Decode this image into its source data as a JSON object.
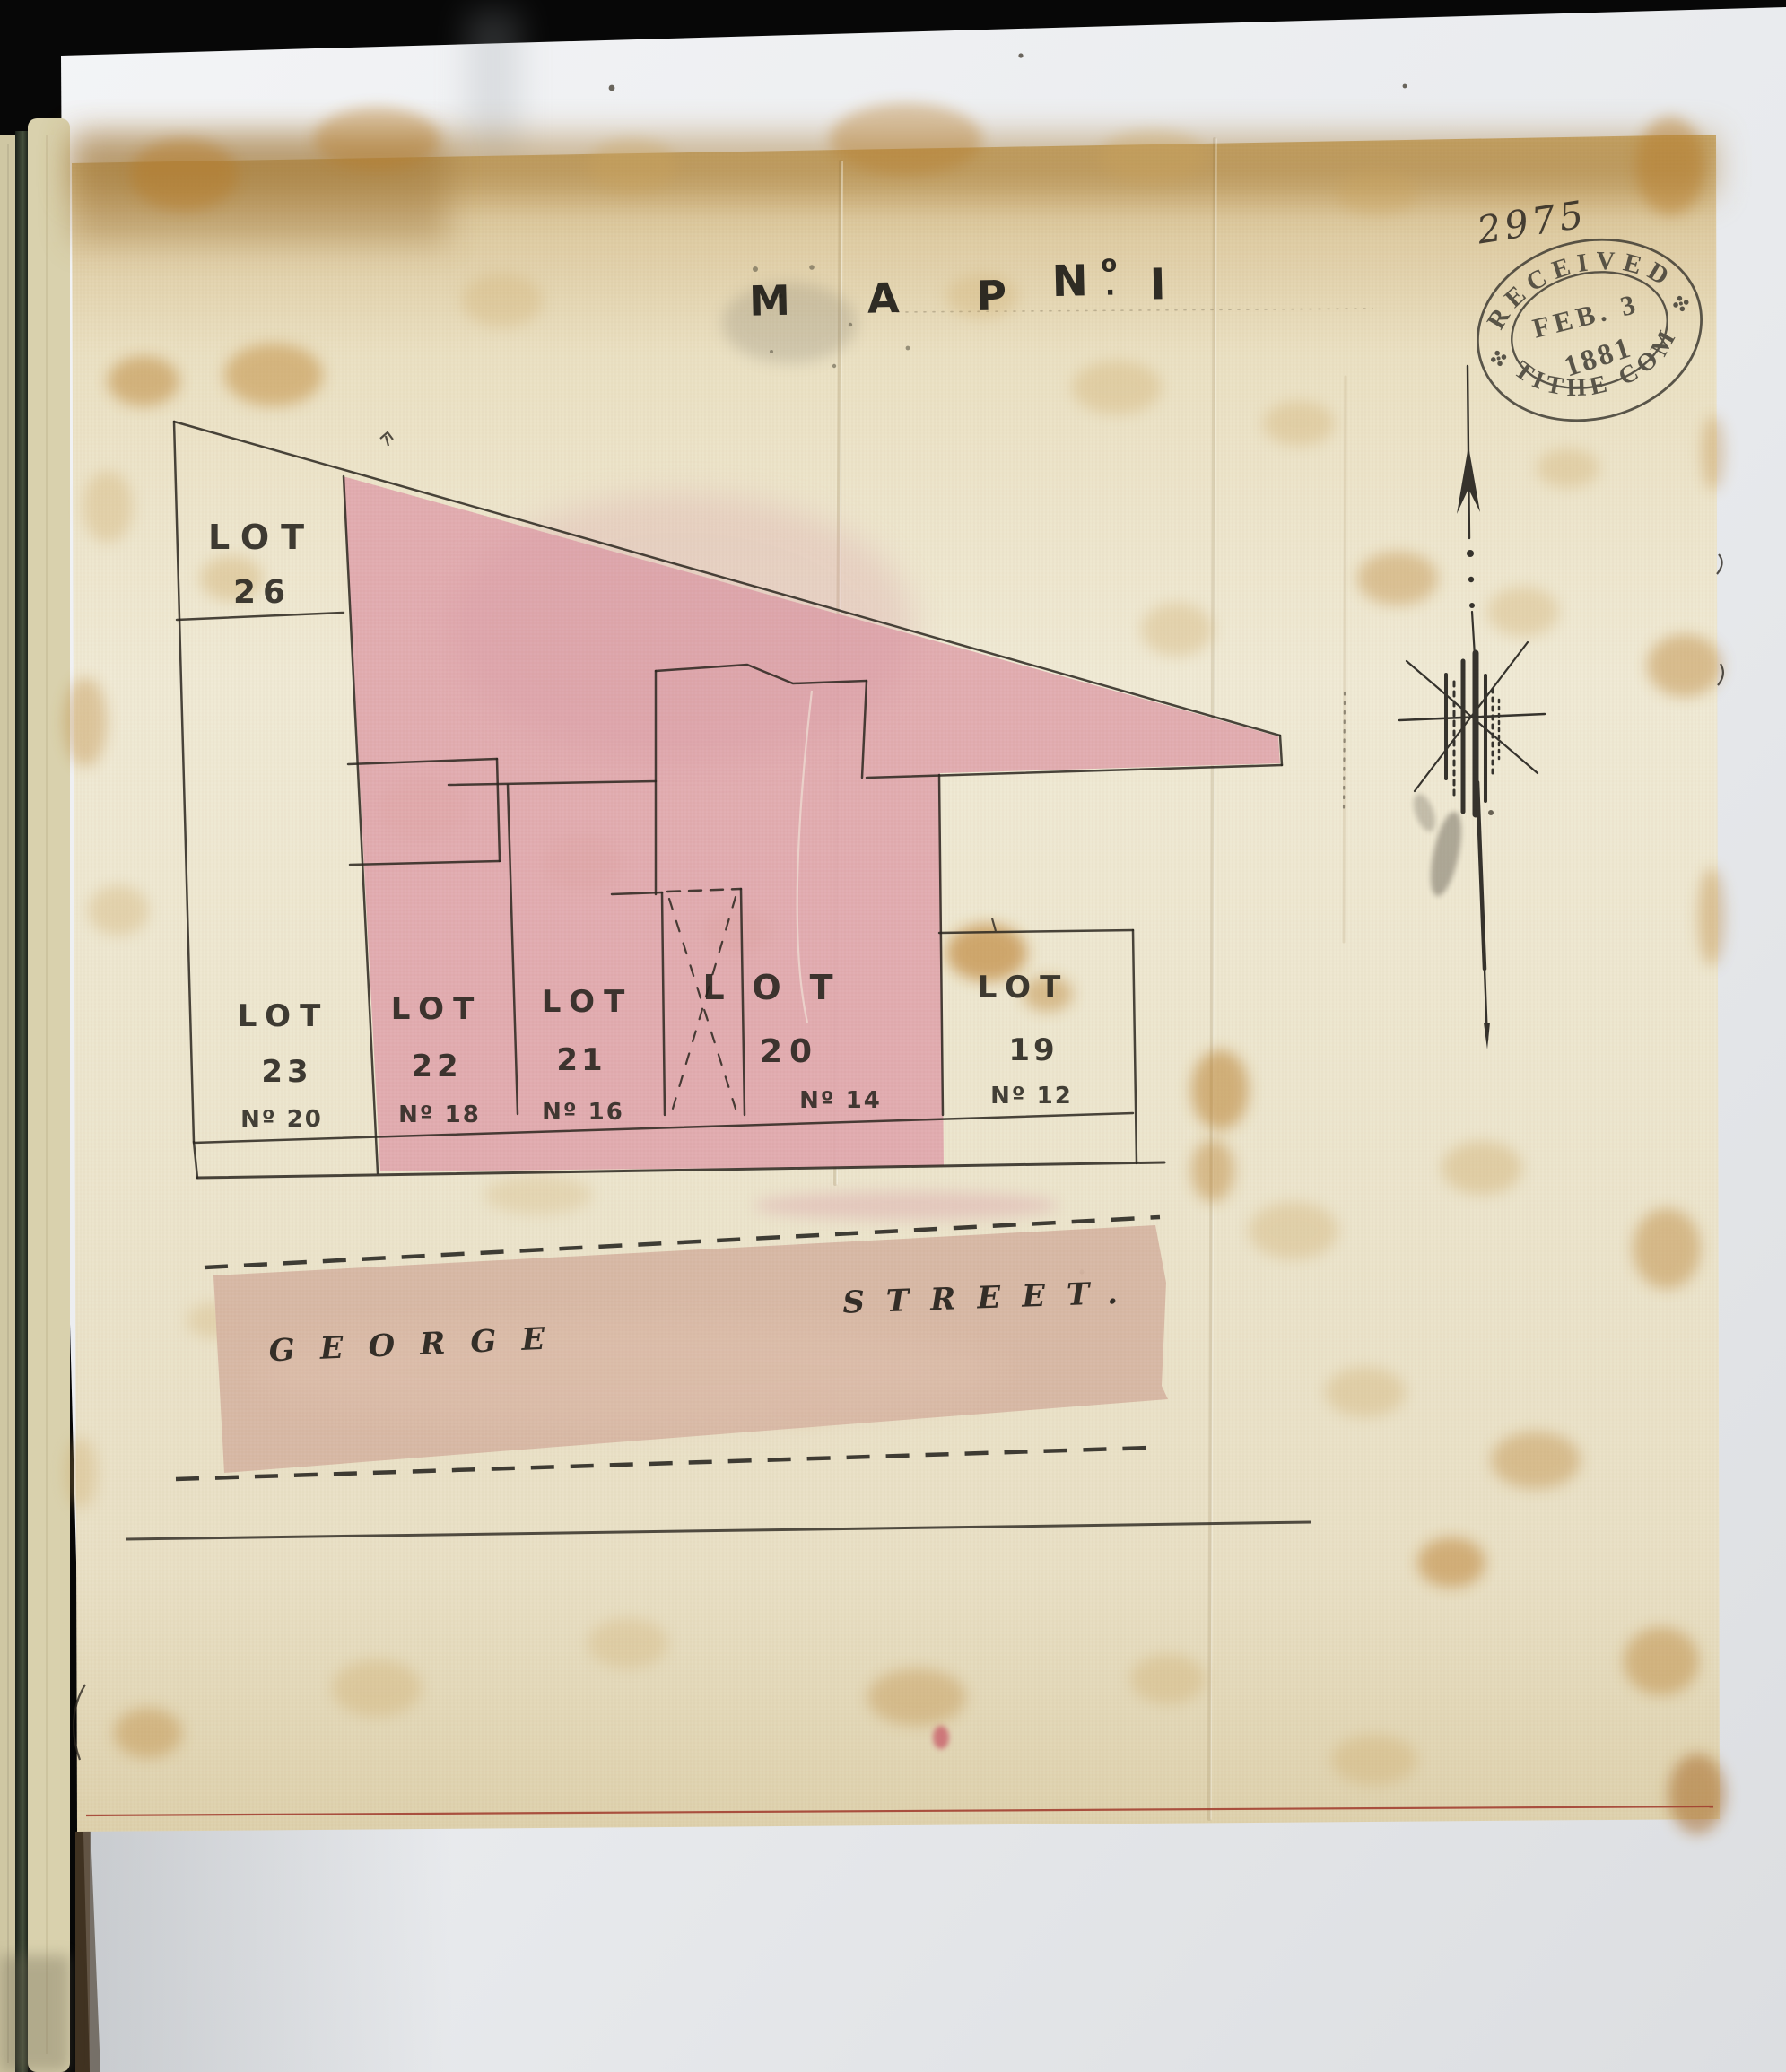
{
  "document": {
    "title": {
      "map_word": "MAP",
      "no_prefix": "N",
      "no_sup": "o",
      "no_dot": ".",
      "numeral": "I"
    },
    "registry_number": "2975",
    "stamp": {
      "arc_top": "RECEIVED",
      "arc_bottom": "TITHE COM",
      "date_line1": "FEB. 3",
      "date_line2": "1881"
    },
    "street": {
      "left_word": "GEORGE",
      "right_word": "STREET."
    },
    "lots": [
      {
        "id": "26",
        "label": "LOT",
        "number": "26",
        "house_no": ""
      },
      {
        "id": "23",
        "label": "LOT",
        "number": "23",
        "house_no": "Nº 20"
      },
      {
        "id": "22",
        "label": "LOT",
        "number": "22",
        "house_no": "Nº 18"
      },
      {
        "id": "21",
        "label": "LOT",
        "number": "21",
        "house_no": "Nº 16"
      },
      {
        "id": "20",
        "label": "LOT",
        "number": "20",
        "house_no": "Nº 14"
      },
      {
        "id": "19",
        "label": "LOT",
        "number": "19",
        "house_no": "Nº 12"
      }
    ],
    "colors": {
      "parcel_pink": "#dfa6ad",
      "street_band": "#d6b5a2",
      "vellum": "#ece5cd",
      "ink": "#26231d",
      "stamp_ink": "#3a372f",
      "red_rule": "#a0392b"
    }
  }
}
